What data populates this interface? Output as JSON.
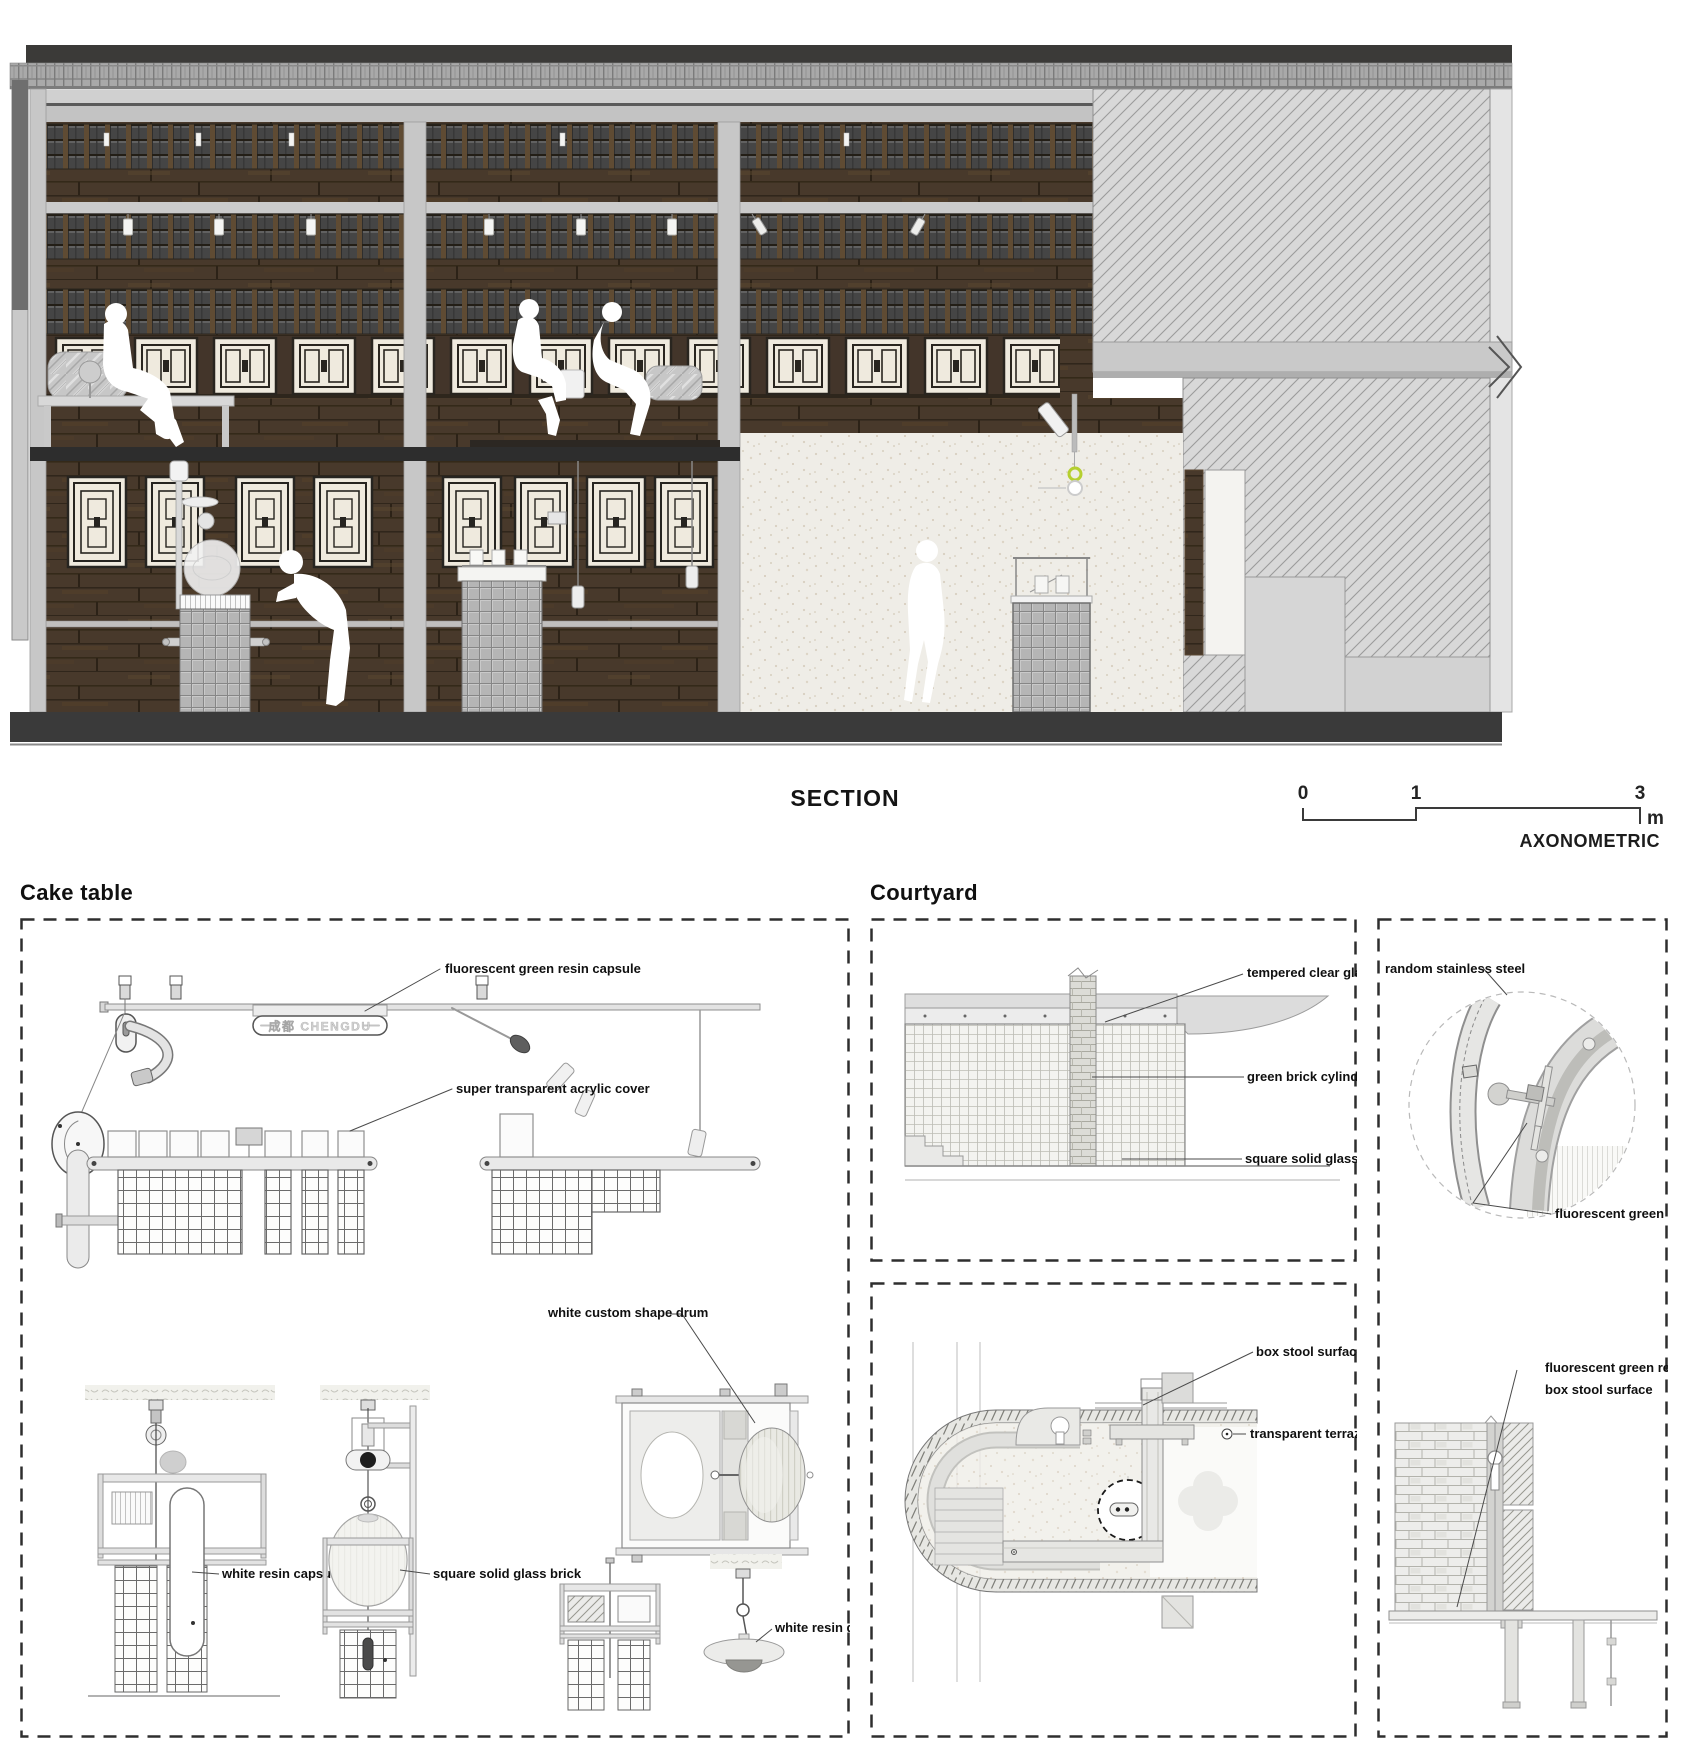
{
  "section": {
    "title": "SECTION",
    "scale": {
      "t0": "0",
      "t1": "1",
      "t3": "3",
      "unit": "m",
      "axonometric": "AXONOMETRIC"
    }
  },
  "cake_table": {
    "title": "Cake table",
    "capsule_text": "成都 CHENGDU",
    "labels": {
      "fluorescent_capsule": "fluorescent green resin capsule",
      "acrylic_cover": "super transparent acrylic cover",
      "custom_drum": "white custom shape drum",
      "resin_capsule": "white resin capsule",
      "glass_brick": "square solid glass brick",
      "resin_disc": "white resin disc"
    }
  },
  "courtyard": {
    "title": "Courtyard",
    "wall_labels": {
      "tempered_glass": "tempered clear glass",
      "brick_cylinder": "green brick cylinder",
      "glass_brick": "square solid glass brick"
    },
    "detail_labels": {
      "stainless": "random stainless steel",
      "green_resin": "fluorescent green resin"
    },
    "plan_labels": {
      "box_stool": "box stool surface",
      "terrazzo": "transparent terrazzo"
    },
    "stool_labels": {
      "line1": "fluorescent green resin",
      "line2": "box stool surface"
    }
  },
  "colors": {
    "accent_green": "#b5cf2f",
    "wood": "#46382a",
    "ground_band": "#3a3a3a"
  }
}
